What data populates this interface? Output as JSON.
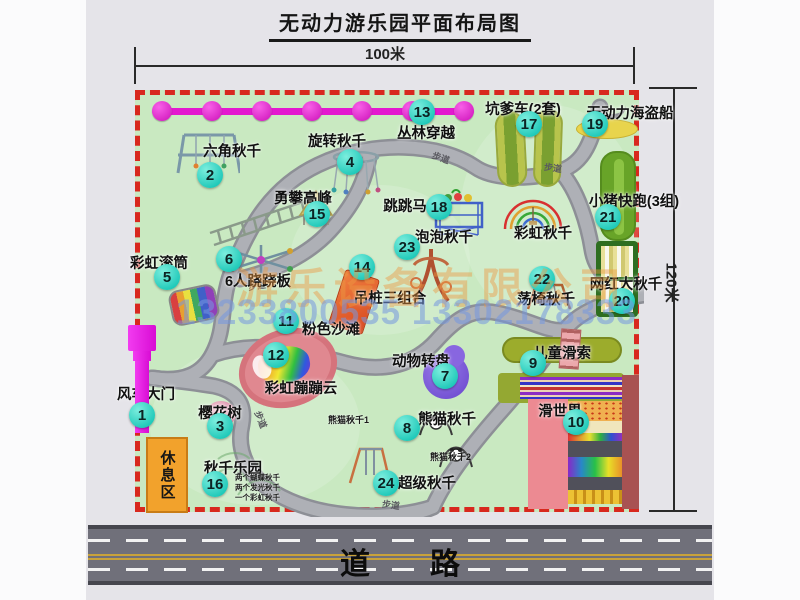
{
  "title": "无动力游乐园平面布局图",
  "dimensions": {
    "width": "100米",
    "height": "120米"
  },
  "road": {
    "label": "道　　路"
  },
  "watermark": {
    "company": "游乐设备有限公司",
    "phones": "13233800535 13302178333"
  },
  "rest_area": {
    "label": "休息区"
  },
  "misc": {
    "path_label": "步道",
    "rainbow_swing_label": "彩虹秋千"
  },
  "sub_labels": {
    "panda1": "熊猫秋千1",
    "panda2": "熊猫秋千2",
    "swing_park_1": "两个蝴蝶秋千",
    "swing_park_2": "两个发光秋千",
    "swing_park_3": "一个彩虹秋千"
  },
  "attractions": [
    {
      "num": "1",
      "label": "风车大门"
    },
    {
      "num": "2",
      "label": "六角秋千"
    },
    {
      "num": "3",
      "label": "樱花树"
    },
    {
      "num": "4",
      "label": "旋转秋千"
    },
    {
      "num": "5",
      "label": "彩虹滚筒"
    },
    {
      "num": "6",
      "label": "6人跷跷板"
    },
    {
      "num": "7",
      "label": "动物转盘"
    },
    {
      "num": "8",
      "label": "熊猫秋千"
    },
    {
      "num": "9",
      "label": "儿童滑索"
    },
    {
      "num": "10",
      "label": "滑世界"
    },
    {
      "num": "11",
      "label": "粉色沙滩"
    },
    {
      "num": "12",
      "label": "彩虹蹦蹦云"
    },
    {
      "num": "13",
      "label": "丛林穿越"
    },
    {
      "num": "14",
      "label": "吊桩三组合"
    },
    {
      "num": "15",
      "label": "勇攀高峰"
    },
    {
      "num": "16",
      "label": "秋千乐园"
    },
    {
      "num": "17",
      "label": "坑爹车(2套)"
    },
    {
      "num": "18",
      "label": "跳跳马"
    },
    {
      "num": "19",
      "label": "无动力海盗船"
    },
    {
      "num": "20",
      "label": "网红大秋千"
    },
    {
      "num": "21",
      "label": "小猪快跑(3组)"
    },
    {
      "num": "22",
      "label": "荡椅秋千"
    },
    {
      "num": "23",
      "label": "泡泡秋千"
    },
    {
      "num": "24",
      "label": "超级秋千"
    }
  ]
}
